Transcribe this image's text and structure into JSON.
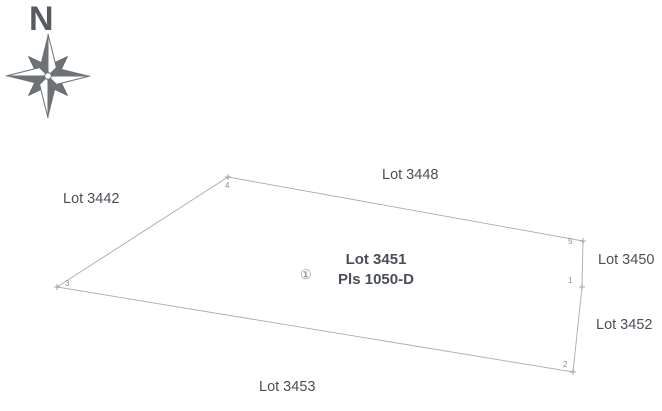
{
  "document": {
    "kind": "survey-sketch-plan"
  },
  "colors": {
    "background": "#ffffff",
    "text": "#4a4f57",
    "boundary_line": "#a8adb0",
    "compass": "#6d7276",
    "vertex_text": "#8a9095"
  },
  "compass": {
    "north_label": "N"
  },
  "parcel": {
    "name": "Lot 3451",
    "plan": "Pls 1050-D",
    "marker": "①"
  },
  "adjacent_lots": [
    {
      "label": "Lot 3442",
      "position": "west"
    },
    {
      "label": "Lot 3448",
      "position": "north"
    },
    {
      "label": "Lot 3450",
      "position": "east-upper"
    },
    {
      "label": "Lot 3452",
      "position": "east-lower"
    },
    {
      "label": "Lot 3453",
      "position": "south"
    }
  ],
  "vertices": [
    {
      "label": "1"
    },
    {
      "label": "2"
    },
    {
      "label": "3"
    },
    {
      "label": "4"
    },
    {
      "label": "5"
    }
  ]
}
